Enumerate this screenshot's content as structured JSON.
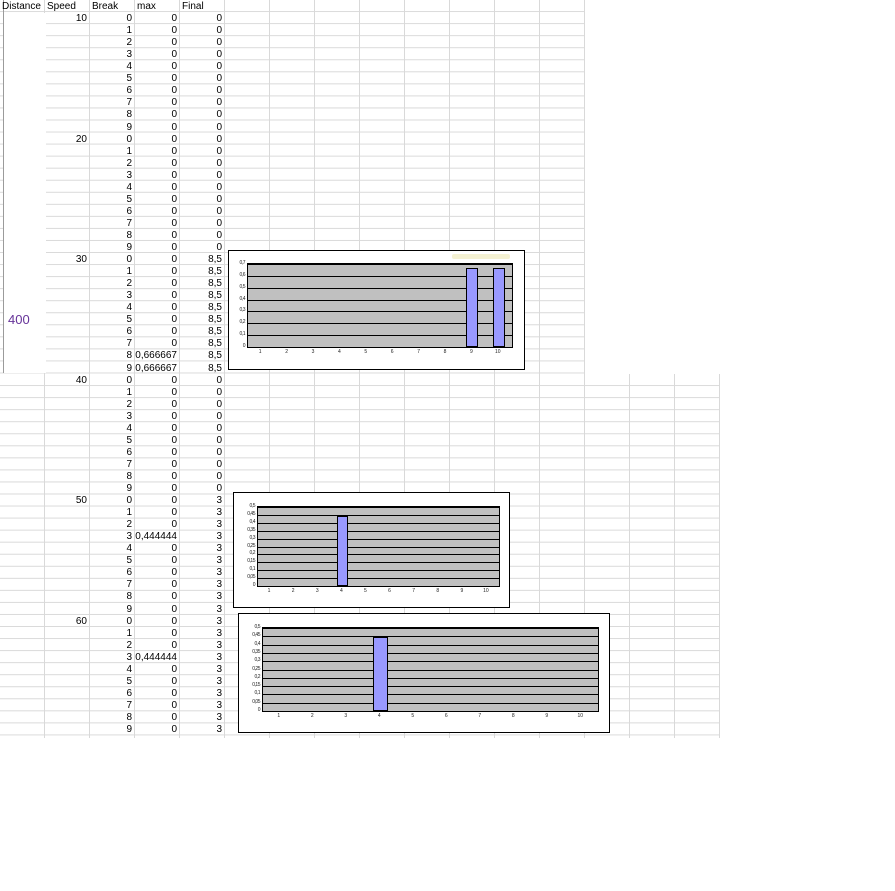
{
  "sheet": {
    "headers": [
      "Distance",
      "Speed",
      "Break",
      "max",
      "Final"
    ],
    "distance_value": "400",
    "break_values": [
      "0",
      "1",
      "2",
      "3",
      "4",
      "5",
      "6",
      "7",
      "8",
      "9"
    ],
    "blocks": [
      {
        "speed": "10",
        "max": [
          "0",
          "0",
          "0",
          "0",
          "0",
          "0",
          "0",
          "0",
          "0",
          "0"
        ],
        "final": [
          "0",
          "0",
          "0",
          "0",
          "0",
          "0",
          "0",
          "0",
          "0",
          "0"
        ]
      },
      {
        "speed": "20",
        "max": [
          "0",
          "0",
          "0",
          "0",
          "0",
          "0",
          "0",
          "0",
          "0",
          "0"
        ],
        "final": [
          "0",
          "0",
          "0",
          "0",
          "0",
          "0",
          "0",
          "0",
          "0",
          "0"
        ]
      },
      {
        "speed": "30",
        "max": [
          "0",
          "0",
          "0",
          "0",
          "0",
          "0",
          "0",
          "0",
          "0,666667",
          "0,666667"
        ],
        "final": [
          "8,5",
          "8,5",
          "8,5",
          "8,5",
          "8,5",
          "8,5",
          "8,5",
          "8,5",
          "8,5",
          "8,5"
        ]
      },
      {
        "speed": "40",
        "max": [
          "0",
          "0",
          "0",
          "0",
          "0",
          "0",
          "0",
          "0",
          "0",
          "0"
        ],
        "final": [
          "0",
          "0",
          "0",
          "0",
          "0",
          "0",
          "0",
          "0",
          "0",
          "0"
        ]
      },
      {
        "speed": "50",
        "max": [
          "0",
          "0",
          "0",
          "0,444444",
          "0",
          "0",
          "0",
          "0",
          "0",
          "0"
        ],
        "final": [
          "3",
          "3",
          "3",
          "3",
          "3",
          "3",
          "3",
          "3",
          "3",
          "3"
        ]
      },
      {
        "speed": "60",
        "max": [
          "0",
          "0",
          "0",
          "0,444444",
          "0",
          "0",
          "0",
          "0",
          "0",
          "0"
        ],
        "final": [
          "3",
          "3",
          "3",
          "3",
          "3",
          "3",
          "3",
          "3",
          "3",
          "3"
        ]
      }
    ]
  },
  "chart_data": [
    {
      "type": "bar",
      "categories": [
        "1",
        "2",
        "3",
        "4",
        "5",
        "6",
        "7",
        "8",
        "9",
        "10"
      ],
      "values": [
        0,
        0,
        0,
        0,
        0,
        0,
        0,
        0,
        0.666667,
        0.666667
      ],
      "title": "",
      "xlabel": "",
      "ylabel": "",
      "ylim": [
        0,
        0.7
      ],
      "yticks": [
        "0,7",
        "0,6",
        "0,5",
        "0,4",
        "0,3",
        "0,2",
        "0,1",
        "0"
      ],
      "legend": "none",
      "grid": "on"
    },
    {
      "type": "bar",
      "categories": [
        "1",
        "2",
        "3",
        "4",
        "5",
        "6",
        "7",
        "8",
        "9",
        "10"
      ],
      "values": [
        0,
        0,
        0,
        0.444444,
        0,
        0,
        0,
        0,
        0,
        0
      ],
      "title": "",
      "xlabel": "",
      "ylabel": "",
      "ylim": [
        0,
        0.5
      ],
      "yticks": [
        "0,5",
        "0,45",
        "0,4",
        "0,35",
        "0,3",
        "0,25",
        "0,2",
        "0,15",
        "0,1",
        "0,05",
        "0"
      ],
      "legend": "none",
      "grid": "on"
    },
    {
      "type": "bar",
      "categories": [
        "1",
        "2",
        "3",
        "4",
        "5",
        "6",
        "7",
        "8",
        "9",
        "10"
      ],
      "values": [
        0,
        0,
        0,
        0.444444,
        0,
        0,
        0,
        0,
        0,
        0
      ],
      "title": "",
      "xlabel": "",
      "ylabel": "",
      "ylim": [
        0,
        0.5
      ],
      "yticks": [
        "0,5",
        "0,45",
        "0,4",
        "0,35",
        "0,3",
        "0,25",
        "0,2",
        "0,15",
        "0,1",
        "0,05",
        "0"
      ],
      "legend": "none",
      "grid": "on"
    }
  ],
  "colors": {
    "bar_fill": "#9999ff",
    "plot_bg": "#c0c0c0",
    "gridline": "#d9d9d9",
    "chart_gridline": "#000000",
    "distance_text": "#663399"
  }
}
